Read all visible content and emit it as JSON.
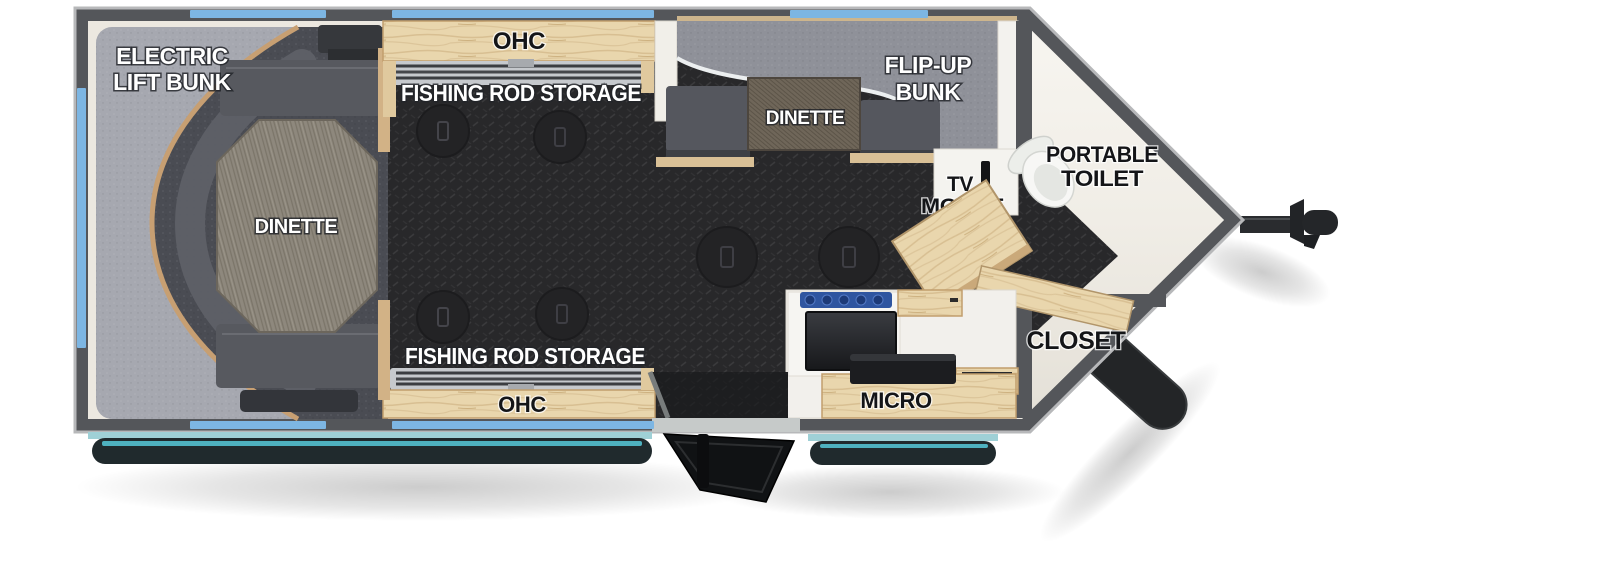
{
  "floorplan": {
    "description": "Top-down RV travel trailer floor plan with V-nose front, toy-hauler style interior",
    "labels": {
      "electric_lift_bunk": [
        "ELECTRIC",
        "LIFT BUNK"
      ],
      "rear_dinette": "DINETTE",
      "ohc_top": "OHC",
      "rod_storage_top": "FISHING ROD STORAGE",
      "flip_up_bunk": [
        "FLIP-UP",
        "BUNK"
      ],
      "front_dinette": "DINETTE",
      "tv_mount": [
        "TV",
        "MOUNT"
      ],
      "portable_toilet": [
        "PORTABLE",
        "TOILET"
      ],
      "closet": "CLOSET",
      "micro": "MICRO",
      "rod_storage_bottom": "FISHING ROD STORAGE",
      "ohc_bottom": "OHC"
    },
    "colors": {
      "wall_gray": "#54565a",
      "interior_cream": "#ece8e0",
      "floor_charcoal": "#28282a",
      "window_blue": "#7db6e3",
      "awning_teal": "#57c9d9",
      "wood_light": "#e9d6ad",
      "mattress_gray": "#a6a8b0",
      "seat_gray": "#55575e",
      "cooktop_blue": "#2f55a0"
    }
  }
}
